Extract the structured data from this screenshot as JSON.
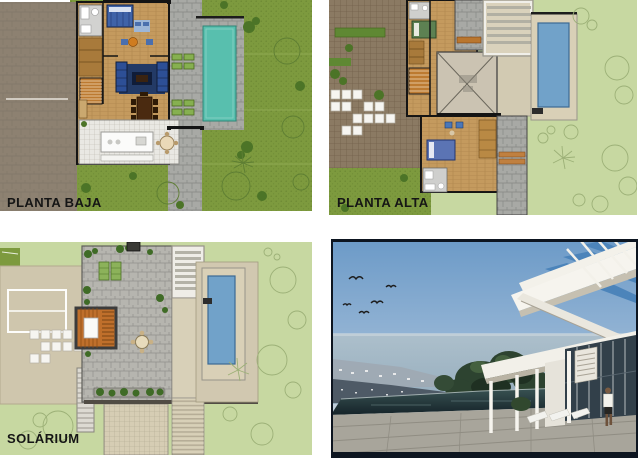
{
  "document": {
    "type": "architectural plan sheet",
    "panels_count": 4
  },
  "panels": {
    "planta_baja": {
      "label": "PLANTA BAJA",
      "content": "ground floor plan with driveway, house, stone path, teal pool, lawn"
    },
    "planta_alta": {
      "label": "PLANTA ALTA",
      "content": "upper floor plan with paver roof, bedrooms, double-height void, terrace, blue pool"
    },
    "solarium": {
      "label": "SOLÁRIUM",
      "content": "roof terrace plan with stone deck, wooden stair box, pergola, blue pool"
    },
    "render": {
      "label": "",
      "content": "exterior 3d render: sea view, coastal town, trees, infinity pool, white modern villa, person on terrace, birds"
    }
  },
  "colors": {
    "lawn_olive": "#7d9a3e",
    "lawn_pale": "#c7d8a1",
    "driveway": "#8d8171",
    "pavers": "#8b7a63",
    "wood_floor": "#c49a5e",
    "stone": "#a8a9a5",
    "pool_teal": "#58bfae",
    "pool_blue": "#71a2c9",
    "deck_beige": "#d9d0b7",
    "roof_beige": "#cfc6ad",
    "frame_navy": "#0d1520",
    "sky": "#6d9bc8",
    "sea": "#9db5c5",
    "pool_dark": "#1d2f33",
    "label_color": "#151515"
  }
}
